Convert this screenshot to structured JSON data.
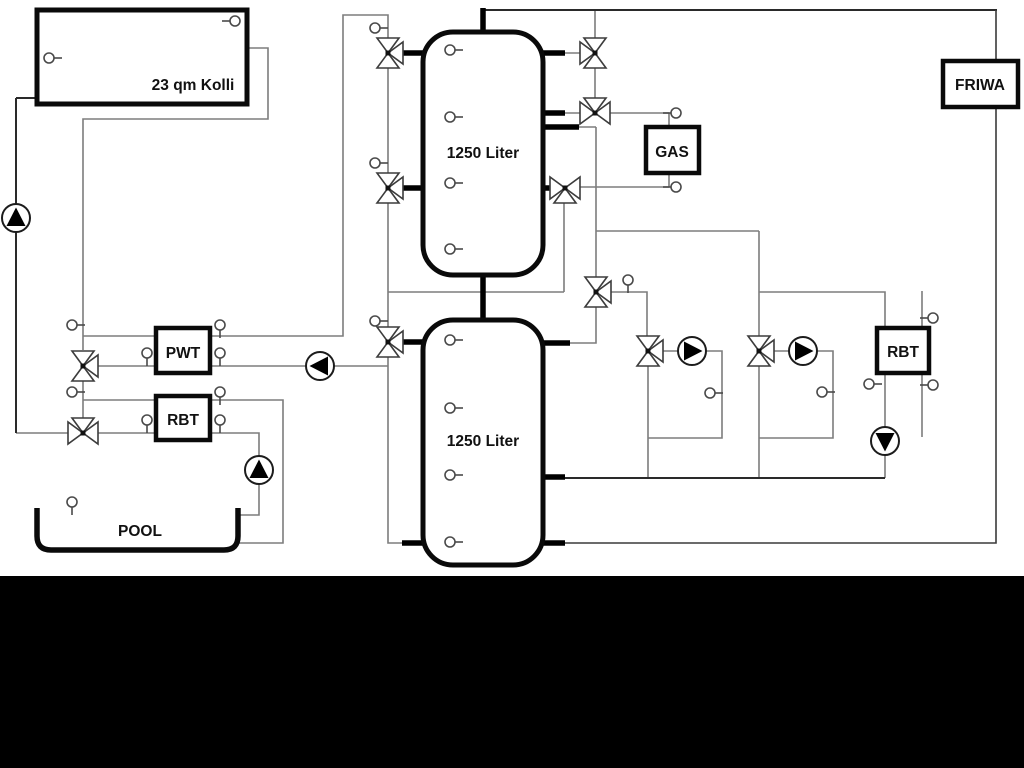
{
  "diagram": {
    "collector_label": "23 qm Kolli",
    "tank1_label": "1250 Liter",
    "tank2_label": "1250 Liter",
    "gas_label": "GAS",
    "friwa_label": "FRIWA",
    "pwt_label": "PWT",
    "rbt_left_label": "RBT",
    "rbt_right_label": "RBT",
    "pool_label": "POOL"
  },
  "colors": {
    "background": "#ffffff",
    "letterbox_band": "#000000",
    "pipe_gray": "#7d7d7d",
    "pipe_black": "#2a2a2a",
    "component_outline": "#0a0a0a"
  }
}
